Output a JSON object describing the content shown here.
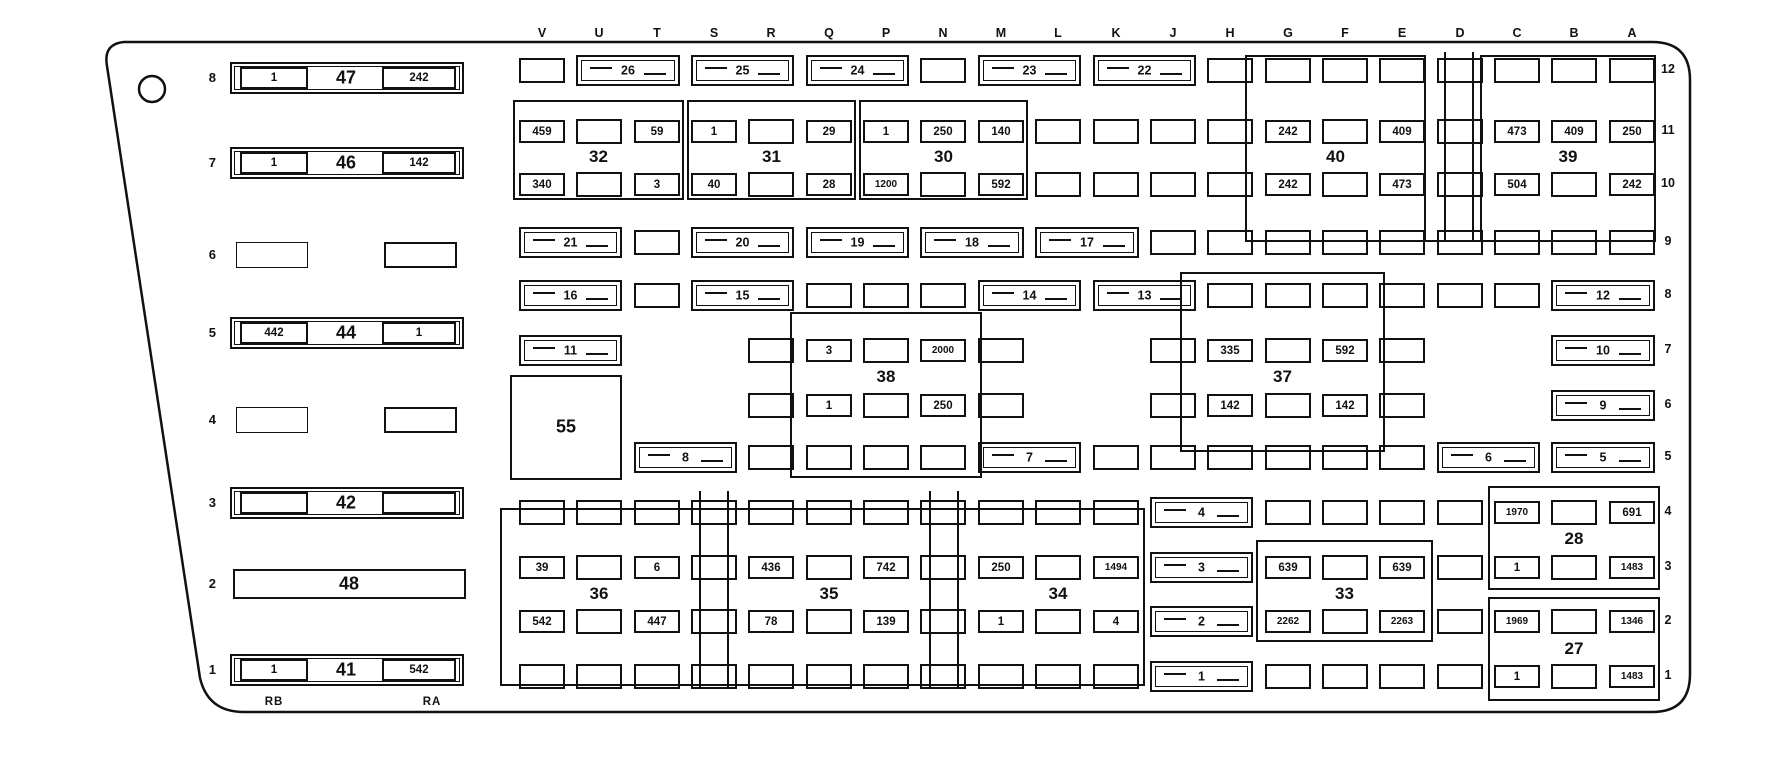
{
  "column_letters": [
    "V",
    "U",
    "T",
    "S",
    "R",
    "Q",
    "P",
    "N",
    "M",
    "L",
    "K",
    "J",
    "H",
    "G",
    "F",
    "E",
    "D",
    "C",
    "B",
    "A"
  ],
  "row_labels": [
    "12",
    "11",
    "10",
    "9",
    "8",
    "7",
    "6",
    "5",
    "4",
    "3",
    "2",
    "1"
  ],
  "corner_labels": {
    "rb": "RB",
    "ra": "RA"
  },
  "left_blocks": [
    {
      "row": "8",
      "type": "block",
      "label": "47",
      "left": "1",
      "right": "242"
    },
    {
      "row": "7",
      "type": "block",
      "label": "46",
      "left": "1",
      "right": "142"
    },
    {
      "row": "6",
      "type": "pair",
      "label": "",
      "left": "",
      "right": ""
    },
    {
      "row": "5",
      "type": "block",
      "label": "44",
      "left": "442",
      "right": "1"
    },
    {
      "row": "4",
      "type": "pair",
      "label": "",
      "left": "",
      "right": ""
    },
    {
      "row": "3",
      "type": "block",
      "label": "42",
      "left": "",
      "right": ""
    },
    {
      "row": "2",
      "type": "plain",
      "label": "48",
      "left": "",
      "right": ""
    },
    {
      "row": "1",
      "type": "block",
      "label": "41",
      "left": "1",
      "right": "542"
    }
  ],
  "relay_labels": {
    "32": "32",
    "31": "31",
    "30": "30",
    "40": "40",
    "39": "39",
    "38": "38",
    "37": "37",
    "33": "33",
    "28": "28",
    "27": "27",
    "36": "36",
    "35": "35",
    "34": "34",
    "55": "55"
  },
  "wide_fuses": [
    [
      12,
      1,
      2,
      "26"
    ],
    [
      12,
      3,
      4,
      "25"
    ],
    [
      12,
      5,
      6,
      "24"
    ],
    [
      12,
      8,
      9,
      "23"
    ],
    [
      12,
      10,
      11,
      "22"
    ],
    [
      9,
      0,
      1,
      "21"
    ],
    [
      9,
      3,
      4,
      "20"
    ],
    [
      9,
      5,
      6,
      "19"
    ],
    [
      9,
      7,
      8,
      "18"
    ],
    [
      9,
      9,
      10,
      "17"
    ],
    [
      8,
      0,
      1,
      "16"
    ],
    [
      8,
      3,
      4,
      "15"
    ],
    [
      8,
      8,
      9,
      "14"
    ],
    [
      8,
      10,
      11,
      "13"
    ],
    [
      8,
      18,
      19,
      "12"
    ],
    [
      7,
      0,
      1,
      "11"
    ],
    [
      7,
      18,
      19,
      "10"
    ],
    [
      6,
      18,
      19,
      "9"
    ],
    [
      5,
      2,
      3,
      "8"
    ],
    [
      5,
      8,
      9,
      "7"
    ],
    [
      5,
      16,
      17,
      "6"
    ],
    [
      5,
      18,
      19,
      "5"
    ],
    [
      4,
      11,
      12,
      "4"
    ],
    [
      3,
      11,
      12,
      "3"
    ],
    [
      2,
      11,
      12,
      "2"
    ],
    [
      1,
      11,
      12,
      "1"
    ]
  ],
  "cells": [
    [
      12,
      0,
      ""
    ],
    [
      12,
      7,
      ""
    ],
    [
      12,
      12,
      ""
    ],
    [
      12,
      13,
      ""
    ],
    [
      12,
      14,
      ""
    ],
    [
      12,
      15,
      ""
    ],
    [
      12,
      16,
      ""
    ],
    [
      12,
      17,
      ""
    ],
    [
      12,
      18,
      ""
    ],
    [
      12,
      19,
      ""
    ],
    [
      11,
      0,
      "459"
    ],
    [
      11,
      1,
      ""
    ],
    [
      11,
      2,
      "59"
    ],
    [
      11,
      3,
      "1"
    ],
    [
      11,
      4,
      ""
    ],
    [
      11,
      5,
      "29"
    ],
    [
      11,
      6,
      "1"
    ],
    [
      11,
      7,
      "250"
    ],
    [
      11,
      8,
      "140"
    ],
    [
      11,
      9,
      ""
    ],
    [
      11,
      10,
      ""
    ],
    [
      11,
      11,
      ""
    ],
    [
      11,
      12,
      ""
    ],
    [
      11,
      13,
      "242"
    ],
    [
      11,
      14,
      ""
    ],
    [
      11,
      15,
      "409"
    ],
    [
      11,
      16,
      ""
    ],
    [
      11,
      17,
      "473"
    ],
    [
      11,
      18,
      "409"
    ],
    [
      11,
      19,
      "250"
    ],
    [
      10,
      0,
      "340"
    ],
    [
      10,
      1,
      ""
    ],
    [
      10,
      2,
      "3"
    ],
    [
      10,
      3,
      "40"
    ],
    [
      10,
      4,
      ""
    ],
    [
      10,
      5,
      "28"
    ],
    [
      10,
      6,
      "1200"
    ],
    [
      10,
      7,
      ""
    ],
    [
      10,
      8,
      "592"
    ],
    [
      10,
      9,
      ""
    ],
    [
      10,
      10,
      ""
    ],
    [
      10,
      11,
      ""
    ],
    [
      10,
      12,
      ""
    ],
    [
      10,
      13,
      "242"
    ],
    [
      10,
      14,
      ""
    ],
    [
      10,
      15,
      "473"
    ],
    [
      10,
      16,
      ""
    ],
    [
      10,
      17,
      "504"
    ],
    [
      10,
      18,
      ""
    ],
    [
      10,
      19,
      "242"
    ],
    [
      9,
      2,
      ""
    ],
    [
      9,
      11,
      ""
    ],
    [
      9,
      12,
      ""
    ],
    [
      9,
      13,
      ""
    ],
    [
      9,
      14,
      ""
    ],
    [
      9,
      15,
      ""
    ],
    [
      9,
      16,
      ""
    ],
    [
      9,
      17,
      ""
    ],
    [
      9,
      18,
      ""
    ],
    [
      9,
      19,
      ""
    ],
    [
      8,
      2,
      ""
    ],
    [
      8,
      5,
      ""
    ],
    [
      8,
      6,
      ""
    ],
    [
      8,
      7,
      ""
    ],
    [
      8,
      12,
      ""
    ],
    [
      8,
      13,
      ""
    ],
    [
      8,
      14,
      ""
    ],
    [
      8,
      15,
      ""
    ],
    [
      8,
      16,
      ""
    ],
    [
      8,
      17,
      ""
    ],
    [
      7,
      4,
      ""
    ],
    [
      7,
      5,
      "3"
    ],
    [
      7,
      6,
      ""
    ],
    [
      7,
      7,
      "2000"
    ],
    [
      7,
      8,
      ""
    ],
    [
      7,
      11,
      ""
    ],
    [
      7,
      12,
      "335"
    ],
    [
      7,
      13,
      ""
    ],
    [
      7,
      14,
      "592"
    ],
    [
      7,
      15,
      ""
    ],
    [
      6,
      4,
      ""
    ],
    [
      6,
      5,
      "1"
    ],
    [
      6,
      6,
      ""
    ],
    [
      6,
      7,
      "250"
    ],
    [
      6,
      8,
      ""
    ],
    [
      6,
      11,
      ""
    ],
    [
      6,
      12,
      "142"
    ],
    [
      6,
      13,
      ""
    ],
    [
      6,
      14,
      "142"
    ],
    [
      6,
      15,
      ""
    ],
    [
      5,
      4,
      ""
    ],
    [
      5,
      5,
      ""
    ],
    [
      5,
      6,
      ""
    ],
    [
      5,
      7,
      ""
    ],
    [
      5,
      10,
      ""
    ],
    [
      5,
      11,
      ""
    ],
    [
      5,
      12,
      ""
    ],
    [
      5,
      13,
      ""
    ],
    [
      5,
      14,
      ""
    ],
    [
      5,
      15,
      ""
    ],
    [
      4,
      0,
      ""
    ],
    [
      4,
      1,
      ""
    ],
    [
      4,
      2,
      ""
    ],
    [
      4,
      3,
      ""
    ],
    [
      4,
      4,
      ""
    ],
    [
      4,
      5,
      ""
    ],
    [
      4,
      6,
      ""
    ],
    [
      4,
      7,
      ""
    ],
    [
      4,
      8,
      ""
    ],
    [
      4,
      9,
      ""
    ],
    [
      4,
      10,
      ""
    ],
    [
      4,
      13,
      ""
    ],
    [
      4,
      14,
      ""
    ],
    [
      4,
      15,
      ""
    ],
    [
      4,
      16,
      ""
    ],
    [
      4,
      17,
      "1970"
    ],
    [
      4,
      18,
      ""
    ],
    [
      4,
      19,
      "691"
    ],
    [
      3,
      0,
      "39"
    ],
    [
      3,
      1,
      ""
    ],
    [
      3,
      2,
      "6"
    ],
    [
      3,
      3,
      ""
    ],
    [
      3,
      4,
      "436"
    ],
    [
      3,
      5,
      ""
    ],
    [
      3,
      6,
      "742"
    ],
    [
      3,
      7,
      ""
    ],
    [
      3,
      8,
      "250"
    ],
    [
      3,
      9,
      ""
    ],
    [
      3,
      10,
      "1494"
    ],
    [
      3,
      13,
      "639"
    ],
    [
      3,
      14,
      ""
    ],
    [
      3,
      15,
      "639"
    ],
    [
      3,
      16,
      ""
    ],
    [
      3,
      17,
      "1"
    ],
    [
      3,
      18,
      ""
    ],
    [
      3,
      19,
      "1483"
    ],
    [
      2,
      0,
      "542"
    ],
    [
      2,
      1,
      ""
    ],
    [
      2,
      2,
      "447"
    ],
    [
      2,
      3,
      ""
    ],
    [
      2,
      4,
      "78"
    ],
    [
      2,
      5,
      ""
    ],
    [
      2,
      6,
      "139"
    ],
    [
      2,
      7,
      ""
    ],
    [
      2,
      8,
      "1"
    ],
    [
      2,
      9,
      ""
    ],
    [
      2,
      10,
      "4"
    ],
    [
      2,
      13,
      "2262"
    ],
    [
      2,
      14,
      ""
    ],
    [
      2,
      15,
      "2263"
    ],
    [
      2,
      16,
      ""
    ],
    [
      2,
      17,
      "1969"
    ],
    [
      2,
      18,
      ""
    ],
    [
      2,
      19,
      "1346"
    ],
    [
      1,
      0,
      ""
    ],
    [
      1,
      1,
      ""
    ],
    [
      1,
      2,
      ""
    ],
    [
      1,
      3,
      ""
    ],
    [
      1,
      4,
      ""
    ],
    [
      1,
      5,
      ""
    ],
    [
      1,
      6,
      ""
    ],
    [
      1,
      7,
      ""
    ],
    [
      1,
      8,
      ""
    ],
    [
      1,
      9,
      ""
    ],
    [
      1,
      10,
      ""
    ],
    [
      1,
      13,
      ""
    ],
    [
      1,
      14,
      ""
    ],
    [
      1,
      15,
      ""
    ],
    [
      1,
      16,
      ""
    ],
    [
      1,
      17,
      "1"
    ],
    [
      1,
      18,
      ""
    ],
    [
      1,
      19,
      "1483"
    ]
  ]
}
